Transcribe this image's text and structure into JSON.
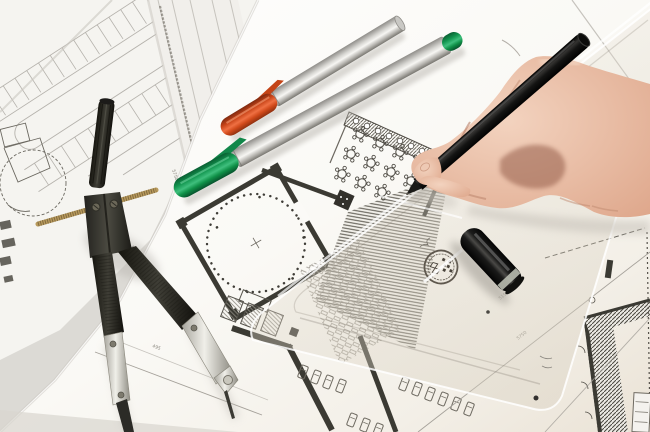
{
  "meta": {
    "description": "Close-up photograph of a hand drawing on architectural floor plans with a black fineliner pen. A drafting compass, an orange-capped and a green-capped marker pen, a black pen cap and a translucent set square lie on overlapping blueprint sheets.",
    "canvas": {
      "width": 650,
      "height": 432
    }
  },
  "objects": {
    "hand": {
      "label": "hand holding black pen",
      "skin_tone": "#e9bda4"
    },
    "black_pen": {
      "label": "black fineliner pen",
      "color": "#141413"
    },
    "compass": {
      "label": "drafting compass",
      "body_color": "#34332e",
      "metal_color": "#d8d6cf",
      "rod_color": "#a98c52"
    },
    "orange_pen": {
      "label": "marker pen with orange cap",
      "cap_color": "#d24d1e",
      "body_color": "#d9d8d4"
    },
    "green_pen": {
      "label": "marker pen with green cap",
      "cap_color": "#14954f",
      "body_color": "#d9d8d4"
    },
    "pen_cap": {
      "label": "black pen cap",
      "color": "#1b1b1a",
      "ring_color": "#b9bdb0"
    },
    "set_square": {
      "label": "translucent set square with round manufacturer stamp",
      "tint": "rgba(228,222,210,0.28)"
    },
    "papers": {
      "label": "overlapping architectural drawing sheets",
      "base_color": "#dcdad5",
      "paper_color": "#fcfbf8"
    },
    "floor_plan": {
      "label": "floor plan: round hall with dotted circle, restaurant tables, hatched walls, parking rows"
    },
    "site_plan": {
      "label": "faint parking-lot site plan"
    }
  },
  "annotations": {
    "dim1": "495",
    "dim2": "5750",
    "dim3": "3512",
    "dim4": "5150"
  }
}
